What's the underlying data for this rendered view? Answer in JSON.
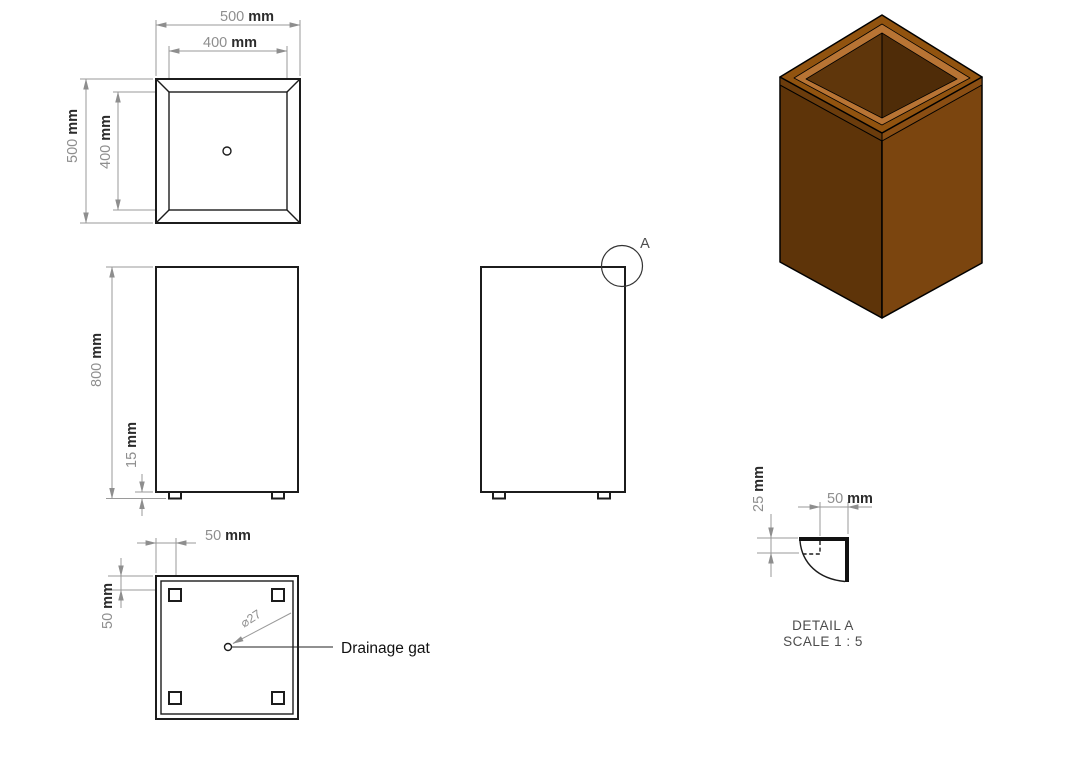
{
  "colors": {
    "line": "#1c1c1c",
    "dimension": "#8e8e8e",
    "unit_text": "#2b2b2b",
    "annotation_text": "#4c4c4c",
    "iso": {
      "left_face": "#5E3409",
      "right_face": "#7B450F",
      "left_band": "#6B3C0C",
      "right_band": "#8A4E13",
      "rim_outer": "#91530F",
      "rim_bevel": "#B87434",
      "inner_left": "#5F360B",
      "inner_right": "#4F2C08"
    }
  },
  "views": {
    "top": {
      "dim_outer_width": {
        "value": "500",
        "unit": "mm"
      },
      "dim_inner_width": {
        "value": "400",
        "unit": "mm"
      },
      "dim_outer_height": {
        "value": "500",
        "unit": "mm"
      },
      "dim_inner_height": {
        "value": "400",
        "unit": "mm"
      }
    },
    "front": {
      "dim_height": {
        "value": "800",
        "unit": "mm"
      },
      "dim_foot_height": {
        "value": "15",
        "unit": "mm"
      }
    },
    "side": {
      "detail_marker": "A"
    },
    "bottom": {
      "dim_foot_offset_h": {
        "value": "50",
        "unit": "mm"
      },
      "dim_foot_offset_v": {
        "value": "50",
        "unit": "mm"
      },
      "drain_hole_diameter": "⌀27",
      "drain_label": "Drainage gat"
    },
    "detail_a": {
      "dim_depth": {
        "value": "25",
        "unit": "mm"
      },
      "dim_width": {
        "value": "50",
        "unit": "mm"
      },
      "title": "DETAIL A",
      "scale_note": "SCALE 1 : 5"
    }
  }
}
